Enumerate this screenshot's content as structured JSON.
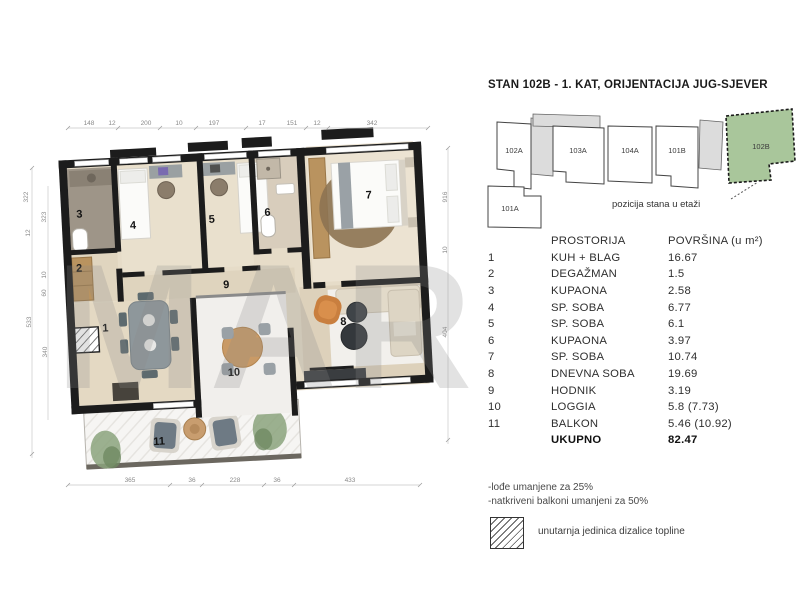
{
  "title": "STAN 102B - 1. KAT, ORIJENTACIJA JUG-SJEVER",
  "watermark": "MAR",
  "position_diagram": {
    "caption": "pozicija stana u etaži",
    "highlight_color": "#a9c69b",
    "units": [
      "102A",
      "103A",
      "104A",
      "101B",
      "102B",
      "101A"
    ]
  },
  "plan": {
    "dims_top": [
      "148",
      "12",
      "200",
      "10",
      "197",
      "17",
      "151",
      "12",
      "342"
    ],
    "dims_bottom": [
      "365",
      "36",
      "228",
      "36",
      "433"
    ],
    "dims_left": [
      "322",
      "12",
      "533",
      "323",
      "10",
      "60",
      "340"
    ],
    "dims_right": [
      "916",
      "10",
      "404"
    ]
  },
  "table": {
    "header": {
      "room": "PROSTORIJA",
      "area": "POVRŠINA (u m²)"
    },
    "rows": [
      {
        "num": "1",
        "name": "KUH + BLAG",
        "area": "16.67"
      },
      {
        "num": "2",
        "name": "DEGAŽMAN",
        "area": "1.5"
      },
      {
        "num": "3",
        "name": "KUPAONA",
        "area": "2.58"
      },
      {
        "num": "4",
        "name": "SP. SOBA",
        "area": "6.77"
      },
      {
        "num": "5",
        "name": "SP. SOBA",
        "area": "6.1"
      },
      {
        "num": "6",
        "name": "KUPAONA",
        "area": "3.97"
      },
      {
        "num": "7",
        "name": "SP. SOBA",
        "area": "10.74"
      },
      {
        "num": "8",
        "name": "DNEVNA SOBA",
        "area": "19.69"
      },
      {
        "num": "9",
        "name": "HODNIK",
        "area": "3.19"
      },
      {
        "num": "10",
        "name": "LOGGIA",
        "area": "5.8  (7.73)"
      },
      {
        "num": "11",
        "name": "BALKON",
        "area": "5.46 (10.92)"
      }
    ],
    "total": {
      "label": "UKUPNO",
      "value": "82.47"
    }
  },
  "notes": [
    "-lođe umanjene za 25%",
    "-natkriveni balkoni umanjeni za 50%"
  ],
  "legend": {
    "text": "unutarnja jedinica dizalice topline"
  }
}
